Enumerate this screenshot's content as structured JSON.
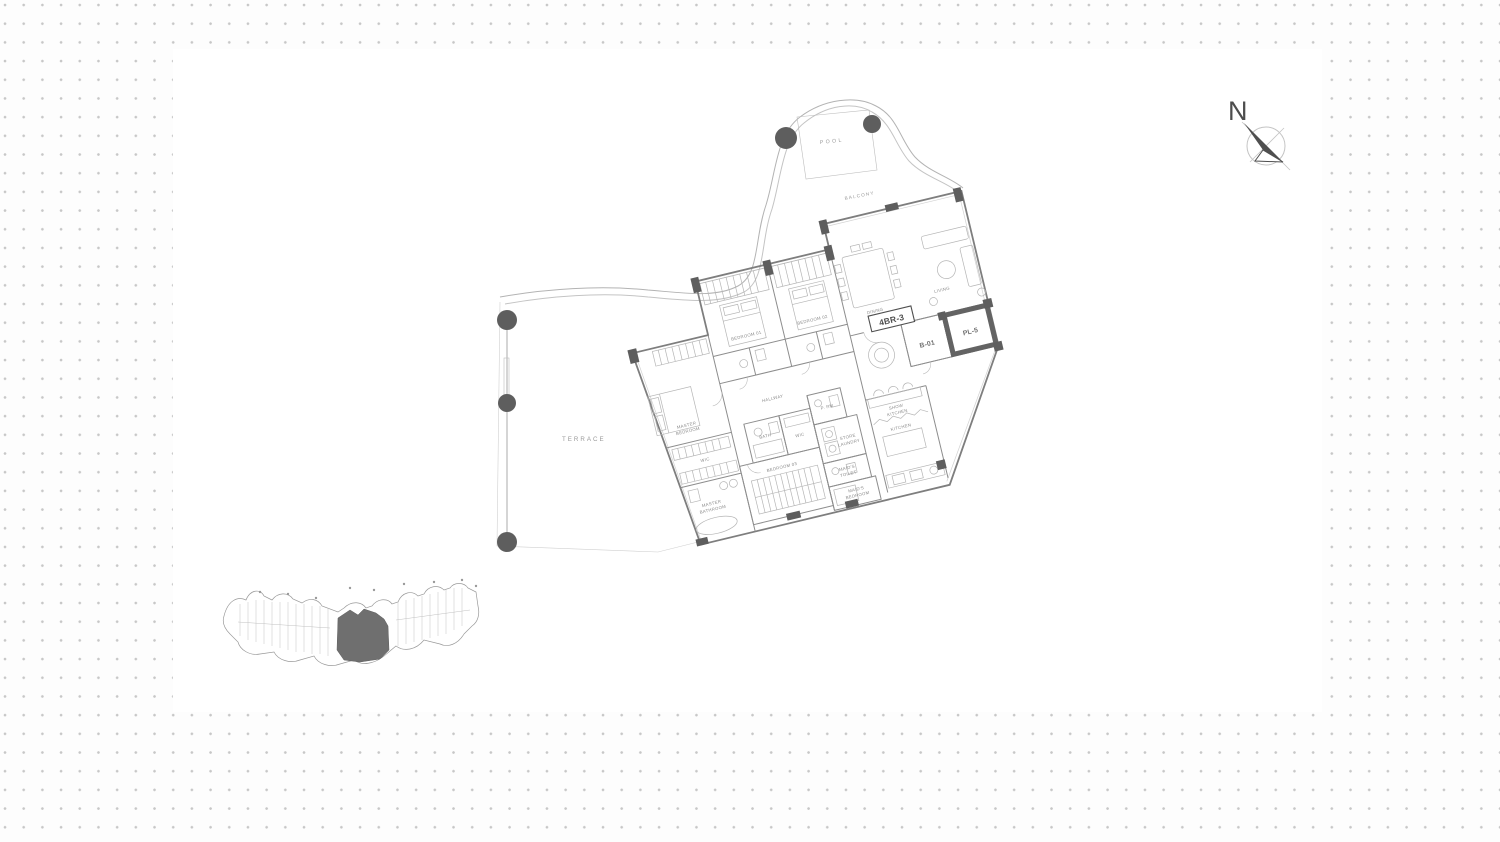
{
  "floor_plan": {
    "unit": {
      "label": "4BR-3",
      "lobby": "B-01",
      "lift": "PL-5"
    },
    "outdoor": {
      "pool": "POOL",
      "balcony": "BALCONY",
      "terrace": "TERRACE"
    },
    "rooms": {
      "dining": "DINING",
      "living": "LIVING",
      "bedroom_01": "BEDROOM 01",
      "bedroom_02": "BEDROOM 02",
      "bedroom_03": "BEDROOM 03",
      "master_bedroom_l1": "MASTER",
      "master_bedroom_l2": "BEDROOM",
      "master_bathroom_l1": "MASTER",
      "master_bathroom_l2": "BATHROOM",
      "hallway": "HALLWAY",
      "bath": "BATH",
      "wic_master": "WIC",
      "wic_2": "WIC",
      "powder_room": "P. RM",
      "store_l1": "STORE",
      "store_l2": "LAUNDRY",
      "maids_toilet_l1": "MAID'S",
      "maids_toilet_l2": "TOILET",
      "maids_bedroom_l1": "MAID'S",
      "maids_bedroom_l2": "BEDROOM",
      "show_kitchen_l1": "SHOW",
      "show_kitchen_l2": "KITCHEN",
      "kitchen": "KITCHEN"
    },
    "compass": {
      "north": "N"
    },
    "colors": {
      "wall_line": "#7e7e7e",
      "column_fill": "#5e5e5e",
      "label_gray": "#8a8a8a",
      "keyplan_highlight": "#6f6f6f",
      "dot_grid": "#c7c7c7"
    }
  }
}
